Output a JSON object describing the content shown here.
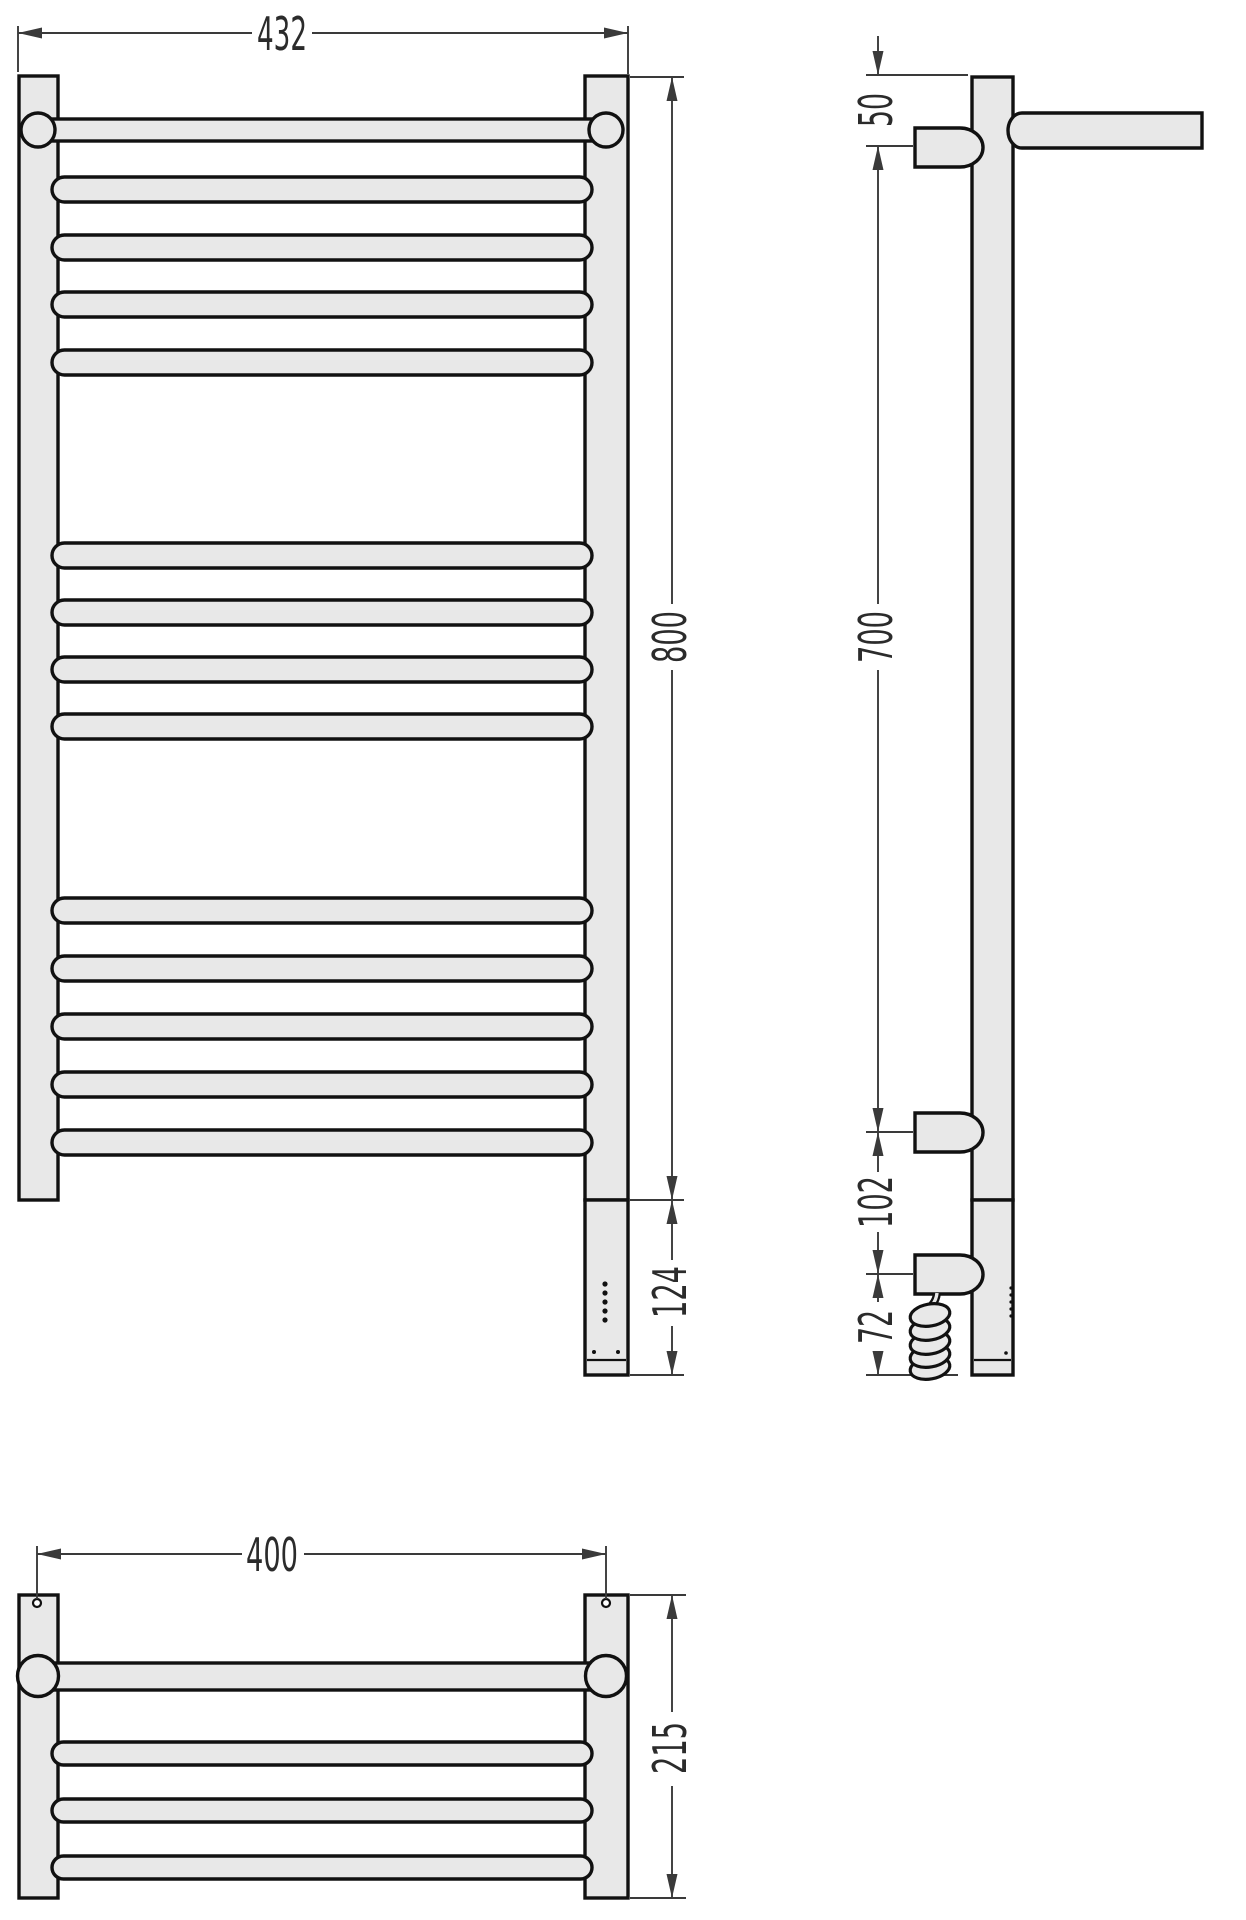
{
  "drawing": {
    "dimensions": {
      "front_width": "432",
      "front_height": "800",
      "front_bottom_unit": "124",
      "side_top_offset": "50",
      "side_bracket_span": "700",
      "side_lower_span": "102",
      "side_cable_span": "72",
      "plan_width": "400",
      "plan_depth": "215"
    },
    "colors": {
      "part_fill": "#e8e8e8",
      "outline": "#111111",
      "dimension_lines": "#3a3a3a",
      "background": "#ffffff"
    }
  }
}
